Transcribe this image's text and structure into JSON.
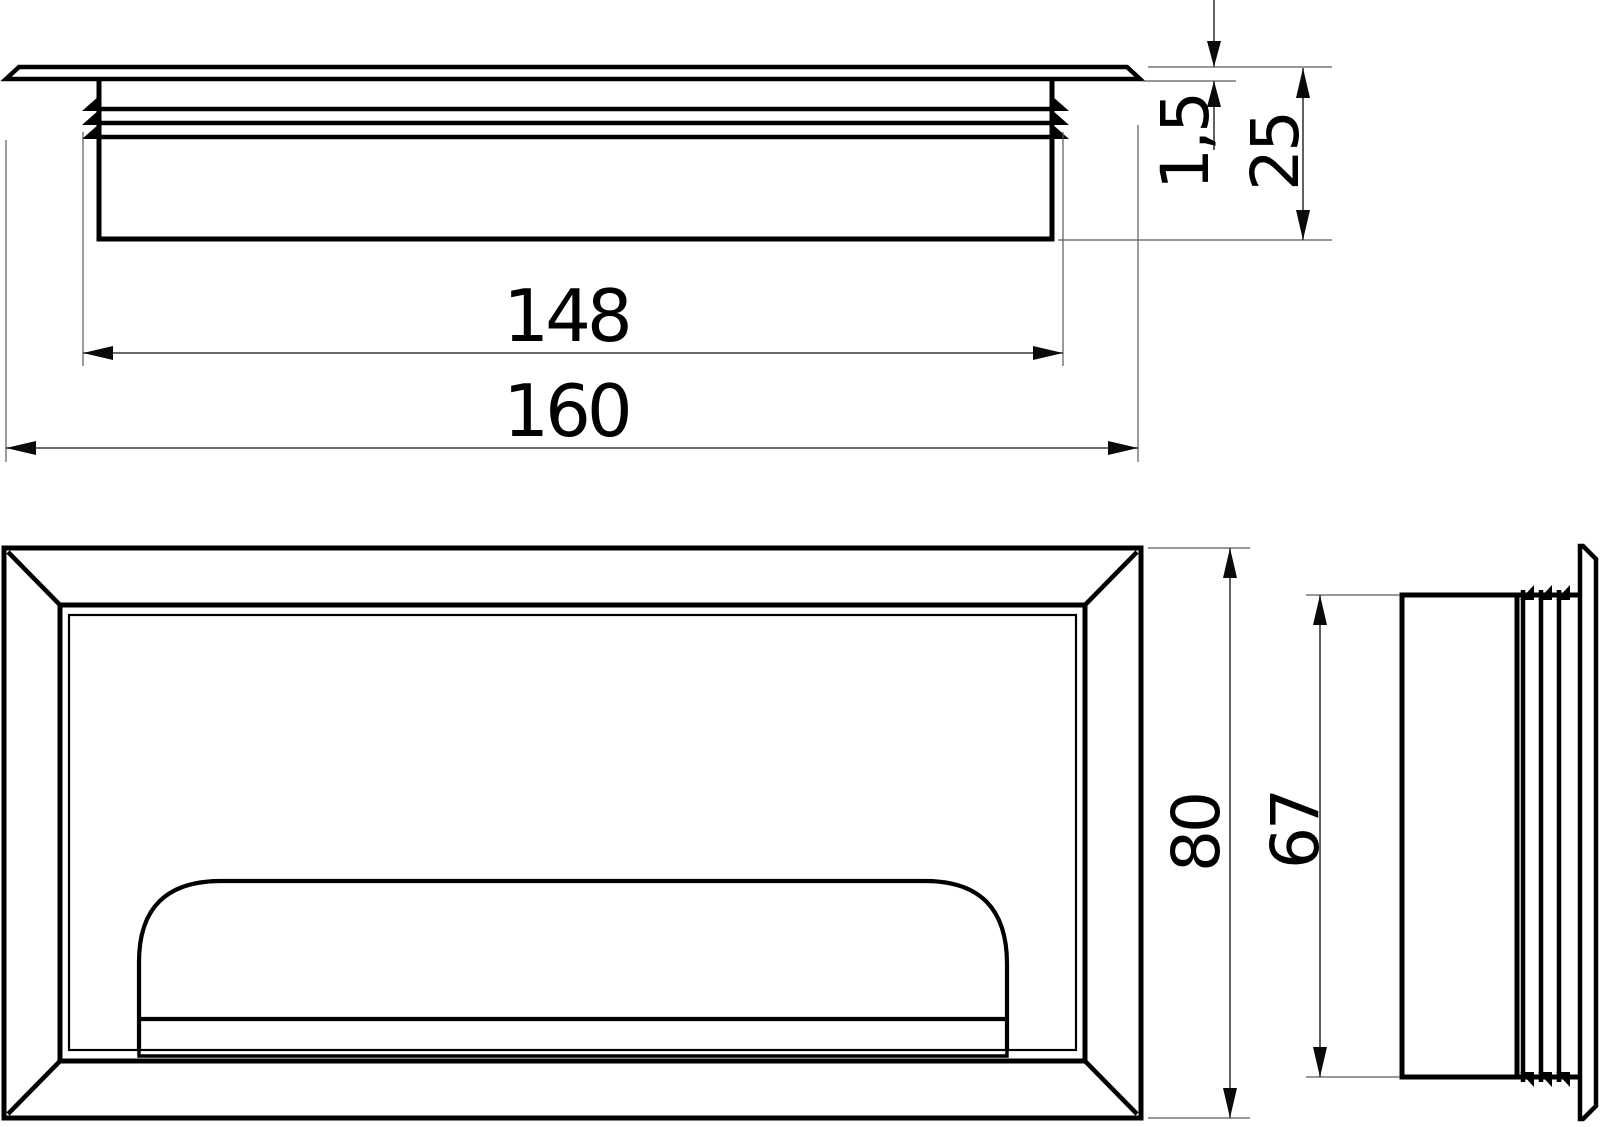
{
  "page": {
    "background": "#ffffff"
  },
  "drawing": {
    "type": "technical-dimension-drawing",
    "subject": "recessed-cable-grommet-handle",
    "stroke_color": "#000000",
    "dim_color": "#3a3a3a",
    "dimensions": {
      "d148": {
        "value": "148",
        "orientation": "horizontal",
        "view": "top-section"
      },
      "d160": {
        "value": "160",
        "orientation": "horizontal",
        "view": "top-section"
      },
      "d1_5": {
        "value": "1,5",
        "orientation": "vertical",
        "view": "top-section"
      },
      "d25": {
        "value": "25",
        "orientation": "vertical",
        "view": "top-section"
      },
      "d80": {
        "value": "80",
        "orientation": "vertical",
        "view": "front"
      },
      "d67": {
        "value": "67",
        "orientation": "vertical",
        "view": "side"
      }
    }
  }
}
